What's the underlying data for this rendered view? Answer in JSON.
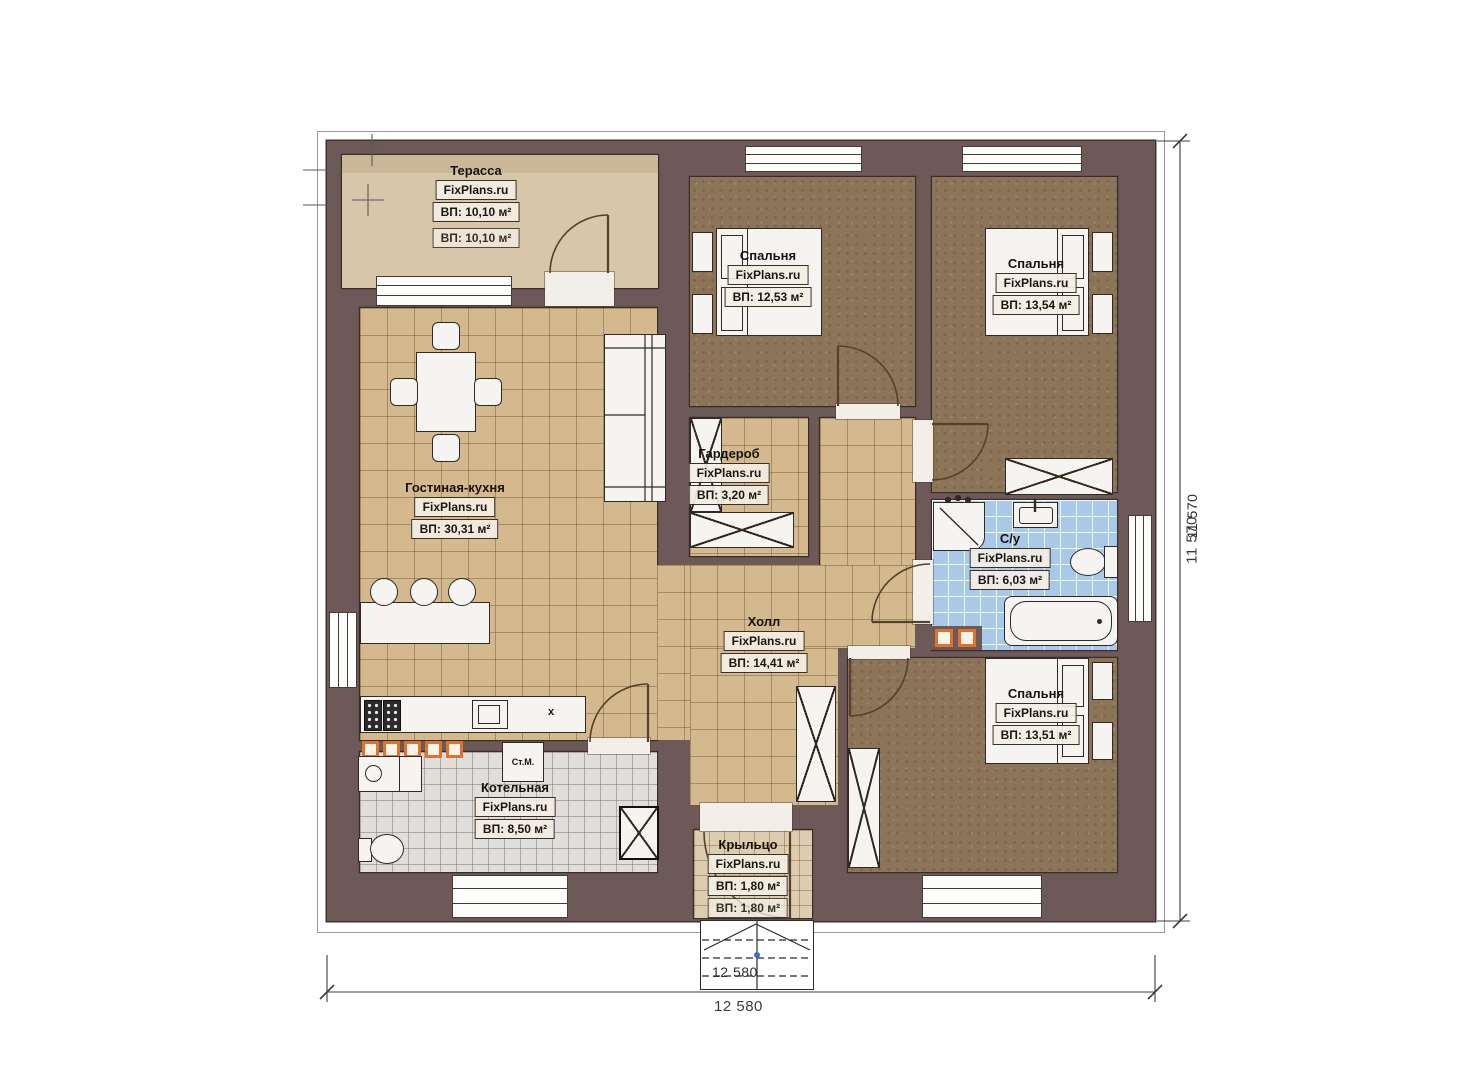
{
  "watermark": "FixPlans.ru",
  "rooms": {
    "terrace": {
      "name": "Терасса",
      "brand": "FixPlans.ru",
      "area": "ВП: 10,10 м²",
      "area_dup": "ВП: 10,10 м²"
    },
    "bedroom1": {
      "name": "Спальня",
      "brand": "FixPlans.ru",
      "area": "ВП: 12,53 м²"
    },
    "bedroom2": {
      "name": "Спальня",
      "brand": "FixPlans.ru",
      "area": "ВП: 13,54 м²"
    },
    "living_kitchen": {
      "name": "Гостиная-кухня",
      "brand": "FixPlans.ru",
      "area": "ВП: 30,31 м²"
    },
    "wardrobe": {
      "name": "Гардероб",
      "brand": "FixPlans.ru",
      "area": "ВП: 3,20 м²"
    },
    "hall": {
      "name": "Холл",
      "brand": "FixPlans.ru",
      "area": "ВП: 14,41 м²"
    },
    "bathroom": {
      "name": "С/у",
      "brand": "FixPlans.ru",
      "area": "ВП: 6,03 м²"
    },
    "bedroom3": {
      "name": "Спальня",
      "brand": "FixPlans.ru",
      "area": "ВП: 13,51 м²"
    },
    "boiler_room": {
      "name": "Котельная",
      "brand": "FixPlans.ru",
      "area": "ВП: 8,50 м²"
    },
    "porch": {
      "name": "Крыльцо",
      "brand": "FixPlans.ru",
      "area": "ВП: 1,80 м²",
      "area_dup": "ВП: 1,80 м²"
    }
  },
  "appliances": {
    "washing_machine_label": "Ст.М.",
    "kitchen_unit_mark": "x"
  },
  "dimensions": {
    "bottom": "12 580",
    "bottom_dup": "12 580",
    "right": "11 570",
    "right_dup": "11 570"
  },
  "colors": {
    "wall": "#6d5957",
    "tan_floor": "#d3b98d",
    "bedroom_floor": "#8b7457",
    "bath_floor": "#a9c9ea",
    "boiler_floor": "#e0dedb",
    "terrace_floor": "#d7c6a8",
    "terrace_band": "#c9b798",
    "porch_floor": "#ddccae",
    "furniture": "#f5f4f1",
    "accent_orange": "#e0722d",
    "label_bg": "rgba(243,238,228,0.92)"
  }
}
